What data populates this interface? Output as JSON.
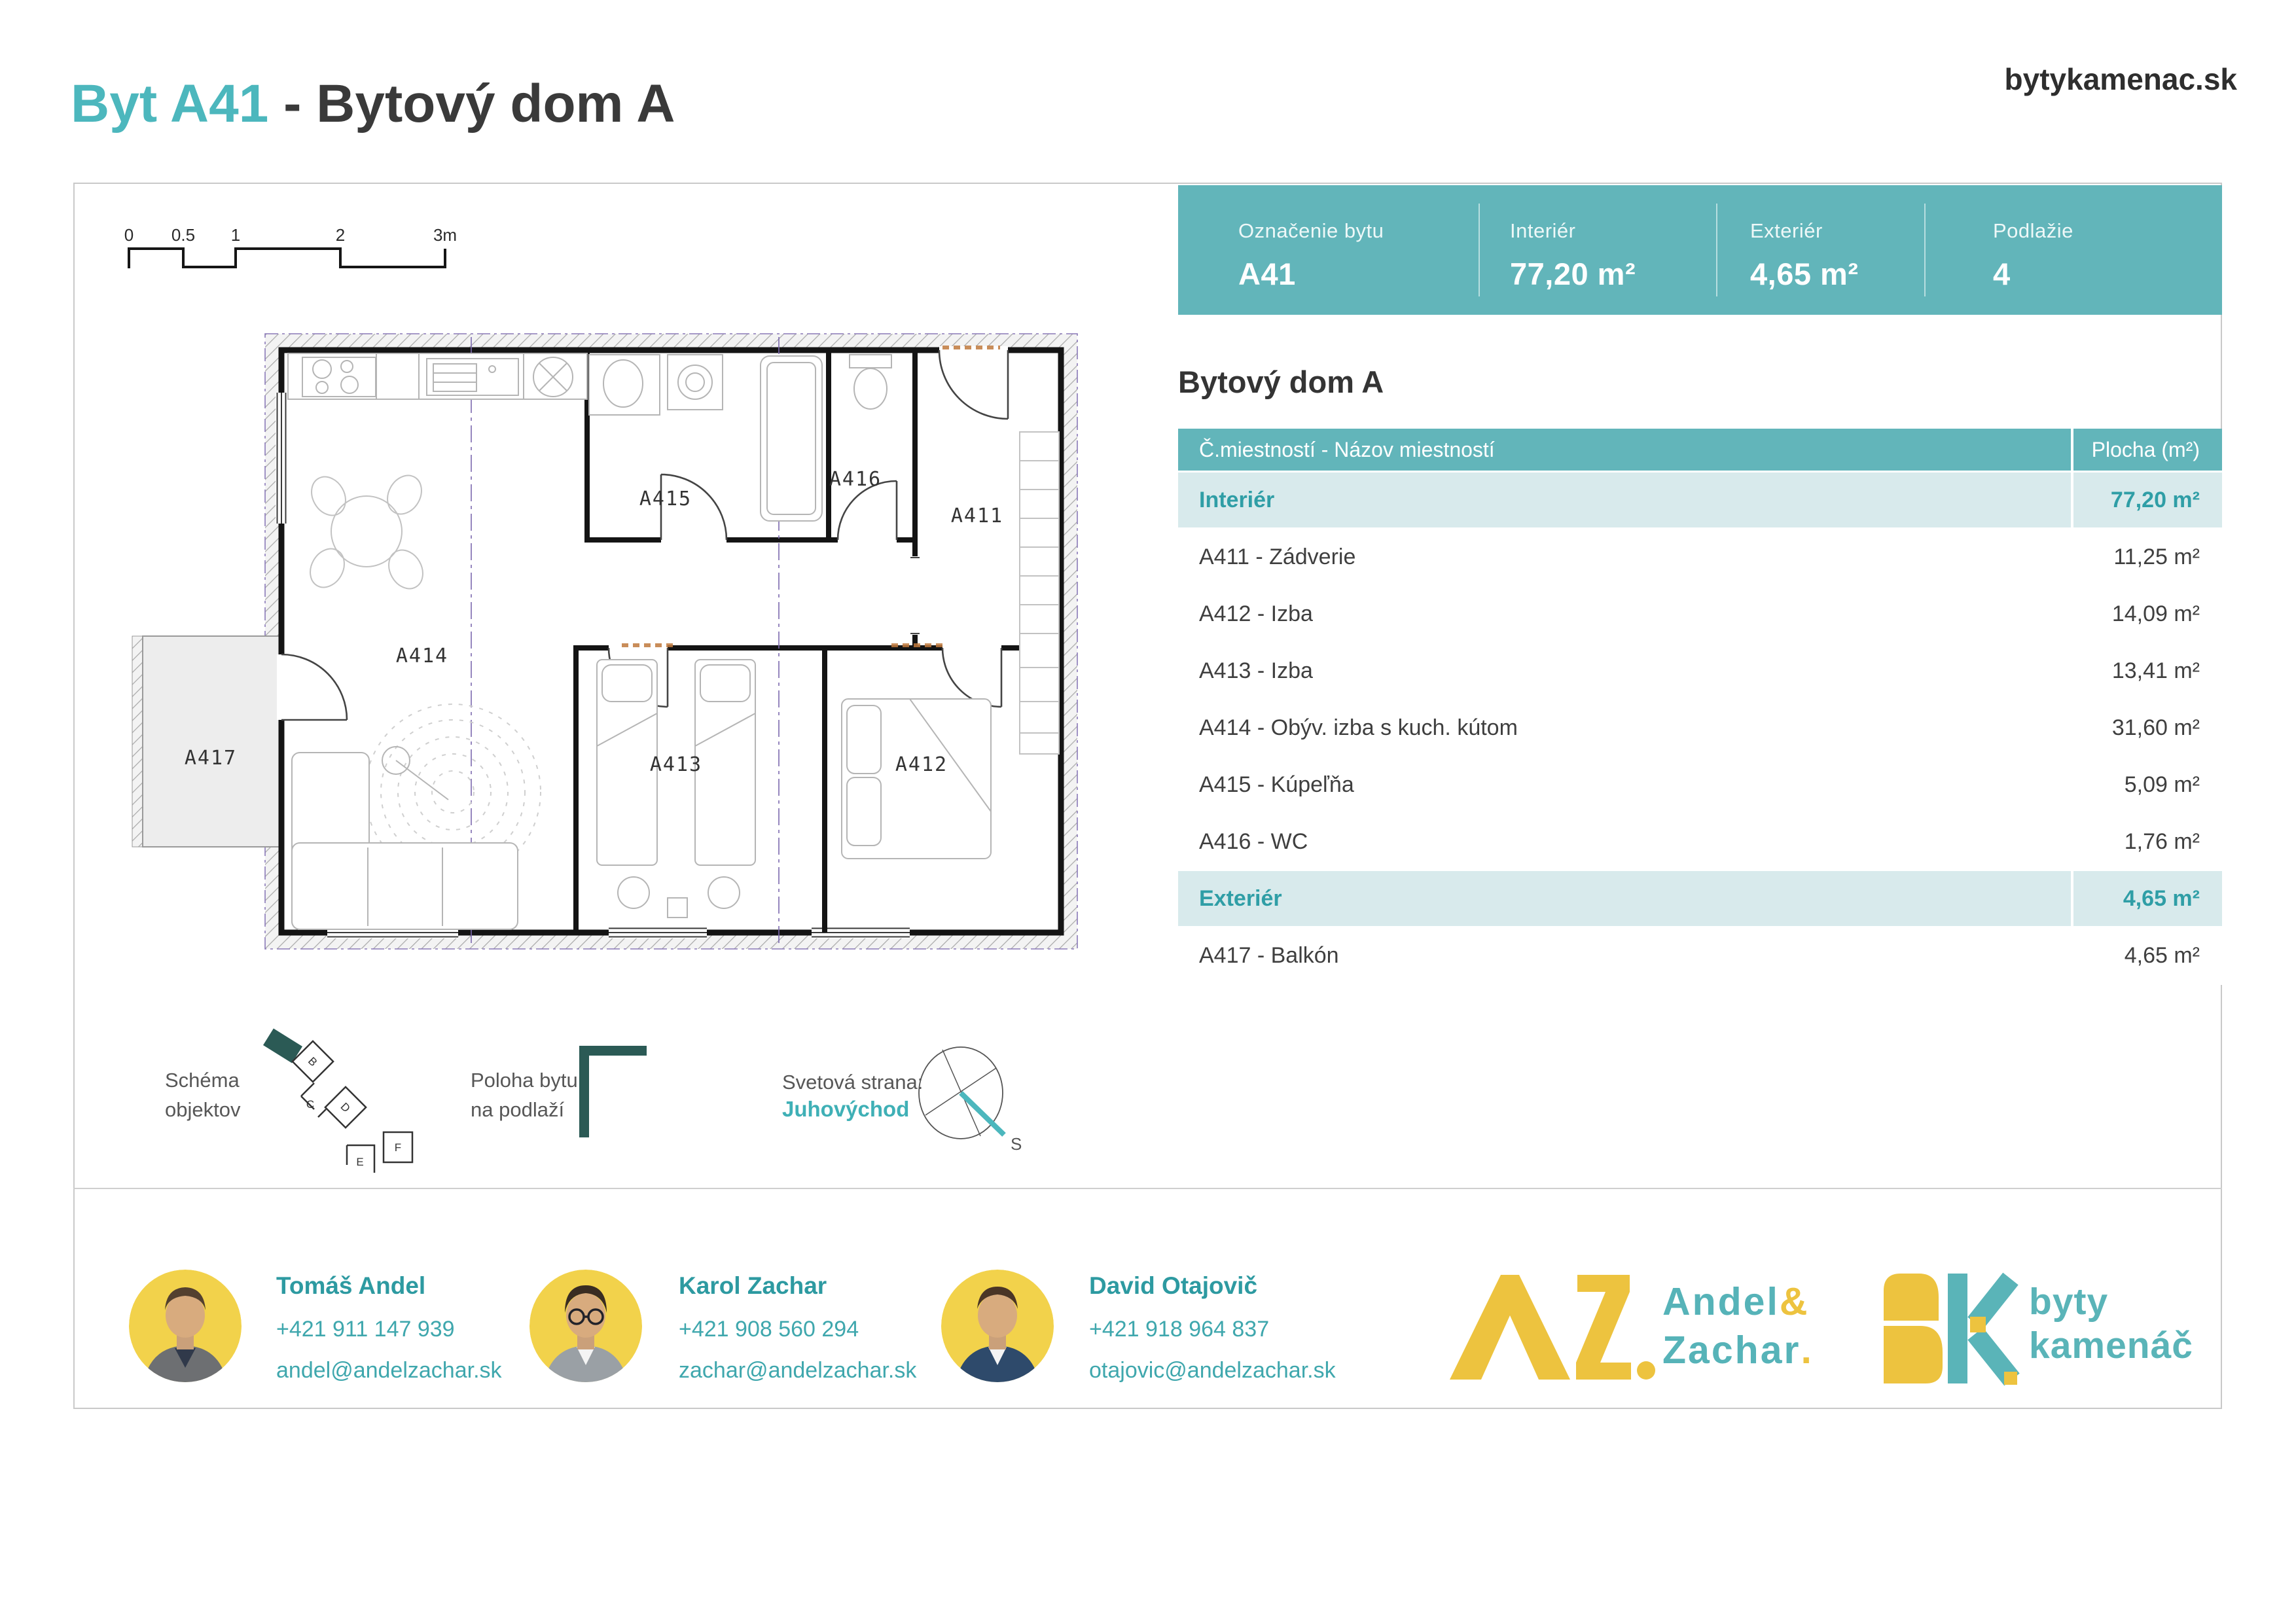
{
  "header": {
    "title_highlight": "Byt A41",
    "title_rest": " - Bytový dom A",
    "website": "bytykamenac.sk"
  },
  "summary_bar": {
    "columns": [
      {
        "label": "Označenie bytu",
        "value": "A41"
      },
      {
        "label": "Interiér",
        "value": "77,20 m²"
      },
      {
        "label": "Exteriér",
        "value": "4,65 m²"
      },
      {
        "label": "Podlažie",
        "value": "4"
      }
    ]
  },
  "building_title": "Bytový dom A",
  "table": {
    "header": {
      "rooms": "Č.miestností - Názov miestností",
      "area": "Plocha (m²)"
    },
    "rows": [
      {
        "label": "Interiér",
        "value": "77,20 m²",
        "type": "group"
      },
      {
        "label": "A411 - Zádverie",
        "value": "11,25 m²",
        "type": "normal"
      },
      {
        "label": "A412 - Izba",
        "value": "14,09 m²",
        "type": "normal"
      },
      {
        "label": "A413 - Izba",
        "value": "13,41 m²",
        "type": "normal"
      },
      {
        "label": "A414 - Obýv. izba s kuch. kútom",
        "value": "31,60 m²",
        "type": "normal"
      },
      {
        "label": "A415 - Kúpeľňa",
        "value": "5,09 m²",
        "type": "normal"
      },
      {
        "label": "A416 - WC",
        "value": "1,76 m²",
        "type": "normal"
      },
      {
        "label": "Exteriér",
        "value": "4,65 m²",
        "type": "group"
      },
      {
        "label": "A417 - Balkón",
        "value": "4,65 m²",
        "type": "normal"
      }
    ]
  },
  "plan": {
    "labels": {
      "a411": "A411",
      "a412": "A412",
      "a413": "A413",
      "a414": "A414",
      "a415": "A415",
      "a416": "A416",
      "a417": "A417"
    },
    "scale_labels": [
      "0",
      "0.5",
      "1",
      "2",
      "3m"
    ]
  },
  "legend": {
    "schema_line1": "Schéma",
    "schema_line2": "objektov",
    "scheme_letters": [
      "B",
      "C",
      "D",
      "E",
      "F"
    ],
    "poloha_line1": "Poloha bytu",
    "poloha_line2": "na podlaží",
    "svetova_label": "Svetová strana:",
    "svetova_value": "Juhovýchod",
    "compass_s": "S"
  },
  "contacts": [
    {
      "name": "Tomáš Andel",
      "phone": "+421 911 147 939",
      "email": "andel@andelzachar.sk"
    },
    {
      "name": "Karol Zachar",
      "phone": "+421 908 560 294",
      "email": "zachar@andelzachar.sk"
    },
    {
      "name": "David Otajovič",
      "phone": "+421 918 964 837",
      "email": "otajovic@andelzachar.sk"
    }
  ],
  "logos": {
    "az": {
      "line1_teal": "Andel",
      "line1_yellow": "&",
      "line2_teal": "Zachar",
      "line2_yellow": "."
    },
    "bk": {
      "line1": "byty",
      "line2": "kamenáč"
    }
  },
  "colors": {
    "accent_teal": "#62b5ba",
    "light_row_teal": "#d8eaec",
    "teal_text": "#2f9ea6",
    "title_teal": "#4cb7bd",
    "logo_yellow": "#edc33f",
    "dark_teal_icon": "#2b5a55",
    "avatar_yellow": "#f2d24b"
  }
}
